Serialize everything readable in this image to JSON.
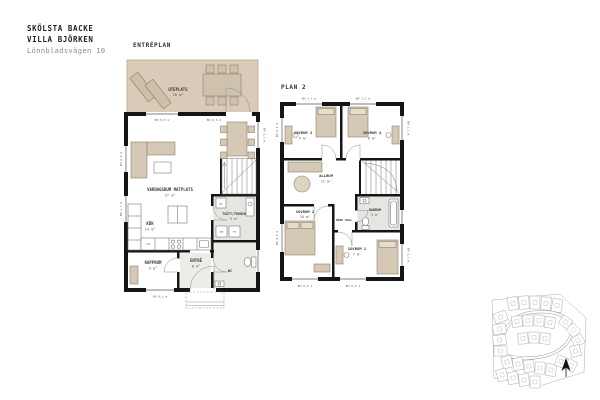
{
  "header": {
    "project": "SKÖLSTA BACKE",
    "house": "VILLA BJÖRKEN",
    "address": "Lönnbladsvägen 10"
  },
  "entreplan": {
    "label": "ENTRÉPLAN",
    "rooms": {
      "uteplats": {
        "name": "UTEPLATS",
        "area": "28 m²"
      },
      "vardagsrum": {
        "name": "VARDAGSRUM MATPLATS",
        "area": "27 m²"
      },
      "kok": {
        "name": "KÖK",
        "area": "14 m²"
      },
      "kapprum": {
        "name": "KAPPRUM",
        "area": "4 m²"
      },
      "entre": {
        "name": "ENTRÉ",
        "area": "8 m²"
      },
      "tvatt_teknik": {
        "name": "TVÄTT/TEKNIK",
        "area": "5 m²"
      },
      "wc": {
        "name": "WC"
      }
    },
    "appliances": {
      "lm": "LM",
      "tm": "TM",
      "tt": "TT",
      "st": "ST"
    }
  },
  "plan2": {
    "label": "PLAN 2",
    "rooms": {
      "sovrum3": {
        "name": "SOVRUM 3",
        "area": "9 m²"
      },
      "sovrum4": {
        "name": "SOVRUM 4",
        "area": "8 m²"
      },
      "allrum": {
        "name": "ALLRUM",
        "area": "11 m²"
      },
      "ovre_hall": {
        "name": "ÖVRE HALL"
      },
      "sovrum2": {
        "name": "SOVRUM 2",
        "area": "10 m²"
      },
      "badrum": {
        "name": "BADRUM",
        "area": "5 m²"
      },
      "sovrum1": {
        "name": "SOVRUM 1",
        "area": "7 m²"
      }
    }
  },
  "window_labels": {
    "bh05": "BH 0,5 m",
    "bh06": "BH 0,6 m",
    "bh08": "BH 0,8 m",
    "bh11": "BH 1,1 m"
  },
  "colors": {
    "terrace": "#d9cbb7",
    "furniture": "#d5c9b5",
    "furniture_stroke": "#8d8170",
    "wall": "#151515",
    "wet_floor": "#e6e5e1",
    "muted_text": "#8a8a8a"
  }
}
